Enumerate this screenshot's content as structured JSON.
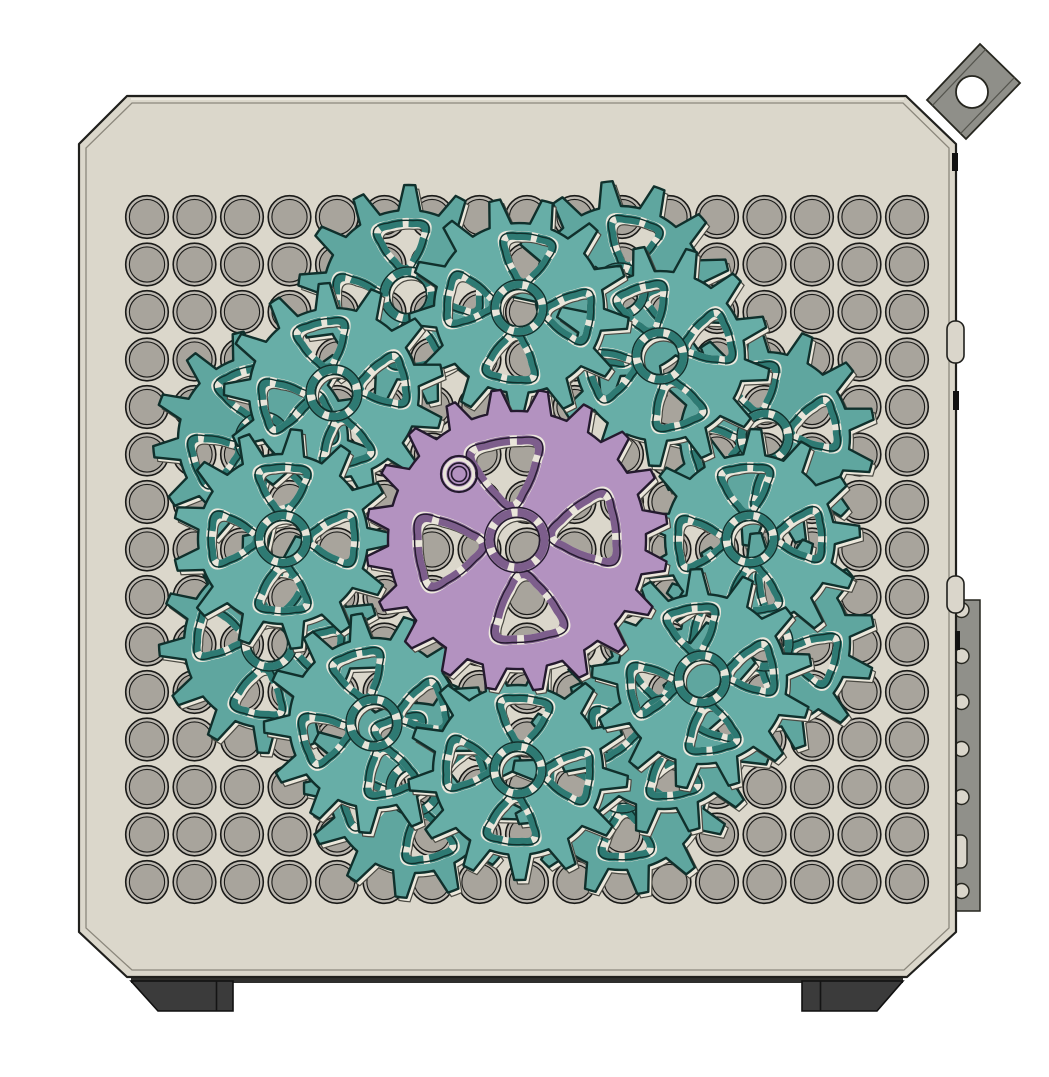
{
  "scene": {
    "canvas": {
      "w": 1049,
      "h": 1077,
      "bg": "#ffffff"
    },
    "panel": {
      "outline": [
        [
          127,
          96
        ],
        [
          906,
          96
        ],
        [
          956,
          144
        ],
        [
          956,
          932
        ],
        [
          907,
          977
        ],
        [
          127,
          977
        ],
        [
          79,
          932
        ],
        [
          79,
          144
        ]
      ],
      "inner": [
        [
          132,
          103
        ],
        [
          903,
          103
        ],
        [
          949,
          148
        ],
        [
          949,
          928
        ],
        [
          904,
          970
        ],
        [
          132,
          970
        ],
        [
          86,
          928
        ],
        [
          86,
          148
        ]
      ],
      "fill": "#dbd7cb",
      "stroke": "#20201d",
      "inner_stroke": "#8b877c",
      "highlight": "#f2efe8"
    },
    "grid": {
      "cols": 17,
      "rows": 15,
      "x0": 147,
      "y0": 217,
      "pitch": 47.5,
      "r_outer": 21.3,
      "r_inner": 17.6,
      "ring_fill": "#bcb8b0",
      "hole_fill": "#a8a49c",
      "stroke": "#1a1a18"
    },
    "bracket": {
      "quad": [
        [
          927,
          100
        ],
        [
          980,
          44
        ],
        [
          1020,
          83
        ],
        [
          966,
          139
        ]
      ],
      "hole": {
        "cx": 972,
        "cy": 92,
        "r": 16
      },
      "fill": "#8f8f89",
      "stroke": "#26261f",
      "hole_fill": "#ffffff",
      "layer_fracs": [
        0.14,
        0.86
      ],
      "layer_stroke": "#55554e"
    },
    "side_plate": {
      "x": 954,
      "y": 600,
      "w": 26,
      "h": 311,
      "fill": "#90908a",
      "stroke": "#26261f",
      "hole_x": 961.5,
      "hole_r": 7.5,
      "hole_ys": [
        610,
        656,
        702,
        749,
        797,
        891
      ],
      "hole_fill": "#dad6cb",
      "notch": {
        "x": 953,
        "y": 835,
        "w": 14,
        "h": 33,
        "rx": 6
      }
    },
    "edge_slots": [
      {
        "x": 947,
        "y": 321,
        "w": 17,
        "h": 42,
        "rx": 8
      },
      {
        "x": 947,
        "y": 576,
        "w": 17,
        "h": 37,
        "rx": 8
      }
    ],
    "edge_slot_fill": "#dad6cb",
    "edge_ticks": [
      {
        "x": 952,
        "y": 153,
        "w": 6,
        "h": 18
      },
      {
        "x": 953,
        "y": 391,
        "w": 6,
        "h": 19
      },
      {
        "x": 955,
        "y": 631,
        "w": 5,
        "h": 19
      }
    ],
    "tick_fill": "#111111",
    "bottom_trim": {
      "x": 131,
      "y": 976,
      "w": 772,
      "h": 7,
      "fill": "#2f2f2d"
    },
    "feet": {
      "fill": "#3b3b3b",
      "stroke": "#101010",
      "seam_stroke": "#141414",
      "left": {
        "poly": [
          [
            131,
            981
          ],
          [
            233,
            981
          ],
          [
            233,
            1011
          ],
          [
            158,
            1011
          ]
        ],
        "seam_x": 216.5
      },
      "right": {
        "poly": [
          [
            802,
            981
          ],
          [
            903,
            981
          ],
          [
            877,
            1011
          ],
          [
            802,
            1011
          ]
        ],
        "seam_x": 820.5
      }
    },
    "gears": {
      "center": [
        517,
        540
      ],
      "echo": {
        "dx": 3.4,
        "dy": 4.0,
        "fill": "#ebe7db",
        "stroke": "#4a4942"
      },
      "teal_spec": {
        "teeth": 13,
        "r_tip": 110,
        "r_root": 85,
        "tip_frac": 0.105,
        "root_frac": 0.27,
        "cutout_dist": 53,
        "cutout_r": 32,
        "cutout_angles": [
          90,
          0,
          270,
          180
        ],
        "hub_r": 19,
        "band_off": 4.5,
        "band_w": 8.5,
        "outline_off": 9,
        "hl_off": 11.5,
        "tri_bow": 1.13,
        "tri_trim": 0.32,
        "body": "#67aea7",
        "body_back": "#5fa69f",
        "rim": "#2e7a73",
        "stroke": "#10302c",
        "dash_tri": "24 6",
        "dash_hub": "18 6"
      },
      "purple_spec": {
        "teeth": 20,
        "r_tip": 151,
        "r_root": 129,
        "tip_frac": 0.1,
        "root_frac": 0.3,
        "cutout_dist": 73,
        "cutout_r": 46,
        "cutout_angles": [
          90,
          0,
          270,
          180
        ],
        "hub_r": 23,
        "band_off": 4.5,
        "band_w": 9,
        "outline_off": 9.5,
        "hl_off": 12,
        "tri_bow": 1.12,
        "tri_trim": 0.3,
        "body": "#b392c0",
        "rim": "#7d5e8c",
        "stroke": "#241a2e",
        "dash_tri": "34 7",
        "dash_hub": "20 6"
      },
      "front": {
        "pos": [
          [
            750,
            539
          ],
          [
            660,
            356
          ],
          [
            519,
            308
          ],
          [
            334,
            393
          ],
          [
            283,
            539
          ],
          [
            374,
            723
          ],
          [
            518,
            770
          ],
          [
            702,
            679
          ]
        ],
        "rot": [
          4,
          18,
          -8,
          12,
          0,
          16,
          -6,
          10
        ]
      },
      "back": {
        "pos": [
          [
            765,
            437
          ],
          [
            620,
            291
          ],
          [
            408,
            295
          ],
          [
            263,
            440
          ],
          [
            269,
            643
          ],
          [
            414,
            788
          ],
          [
            622,
            785
          ],
          [
            765,
            643
          ],
          [
            664,
            724
          ]
        ],
        "rot": [
          12,
          -14,
          6,
          20,
          -10,
          14,
          4,
          -16,
          9
        ]
      },
      "sun_rot": 8,
      "bearing": {
        "cx": 459,
        "cy": 474,
        "rings": [
          {
            "r": 18,
            "stroke": "#241a2e",
            "w": 2.2,
            "fill": "none"
          },
          {
            "r": 14.5,
            "stroke": "#e9e5da",
            "w": 3.4,
            "fill": "none"
          },
          {
            "r": 11,
            "stroke": "#241a2e",
            "w": 1.8,
            "fill": "none"
          },
          {
            "r": 7.5,
            "stroke": "#241a2e",
            "w": 1.6,
            "fill": "#b392c0"
          }
        ]
      }
    }
  }
}
